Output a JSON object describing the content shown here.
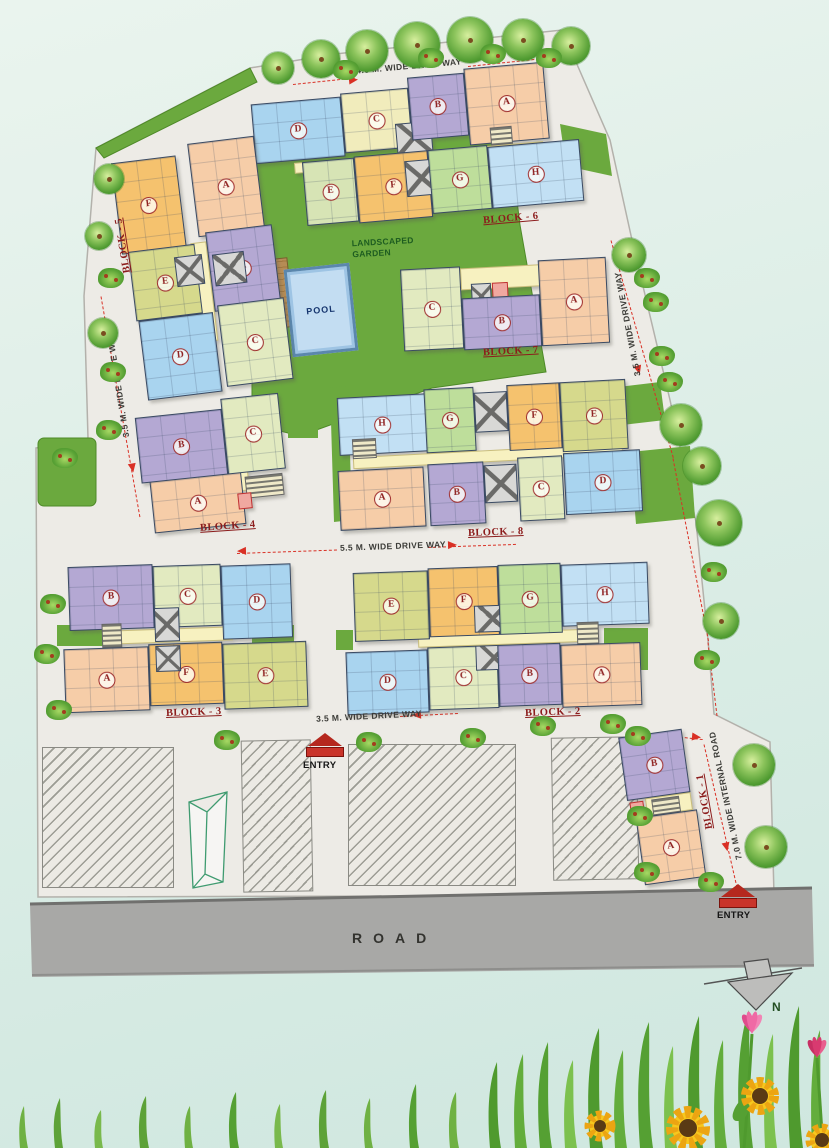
{
  "labels": {
    "landscaped_garden": "LANDSCAPED GARDEN",
    "pool": "POOL",
    "road": "ROAD",
    "north": "N"
  },
  "entries": [
    {
      "label": "ENTRY"
    },
    {
      "label": "ENTRY"
    }
  ],
  "driveways": {
    "top": "4.0 M. WIDE DRIVE WAY",
    "left": "3.5 M. WIDE DRIVE WAY",
    "right": "3.5 M. WIDE DRIVE WAY",
    "middle": "5.5 M. WIDE DRIVE WAY",
    "bottom": "3.5 M. WIDE DRIVE WAY",
    "internal": "7.0 M. WIDE INTERNAL ROAD"
  },
  "blocks": [
    {
      "label": "BLOCK - 1",
      "units": [
        "B",
        "A"
      ]
    },
    {
      "label": "BLOCK - 2",
      "units": [
        "E",
        "F",
        "G",
        "H",
        "D",
        "C",
        "B",
        "A"
      ]
    },
    {
      "label": "BLOCK - 3",
      "units": [
        "B",
        "C",
        "D",
        "A",
        "F",
        "E"
      ]
    },
    {
      "label": "BLOCK - 4",
      "units": [
        "B",
        "C",
        "A"
      ]
    },
    {
      "label": "BLOCK - 5",
      "units": [
        "F",
        "A",
        "E",
        "B",
        "D",
        "C"
      ]
    },
    {
      "label": "BLOCK - 6",
      "units": [
        "D",
        "C",
        "B",
        "A",
        "E",
        "F",
        "G",
        "H"
      ]
    },
    {
      "label": "BLOCK - 7",
      "units": [
        "C",
        "B",
        "A"
      ]
    },
    {
      "label": "BLOCK - 8",
      "units": [
        "H",
        "G",
        "F",
        "E",
        "A",
        "B",
        "C",
        "D"
      ]
    }
  ],
  "palette": {
    "unit_A": "#f6cda8",
    "unit_B": "#b4a8d3",
    "unit_C": "#e2eac0",
    "unit_D": "#a9d4ef",
    "unit_E": "#d6d98c",
    "unit_F": "#f5c26e",
    "unit_G": "#bede9b",
    "unit_H": "#c2e0f4",
    "unit_C_alt": "#f1ecbc",
    "unit_E_alt": "#d7e4b5",
    "garden_green": "#6ba93e",
    "site_gray": "#edebe6",
    "road_gray": "#a8a8a6",
    "corridor_yellow": "#f7f1c0",
    "driveway_red": "#d93025",
    "label_maroon": "#8c1c1c",
    "pool_water": "#c3ddf2",
    "pool_edge": "#5b87ad"
  }
}
